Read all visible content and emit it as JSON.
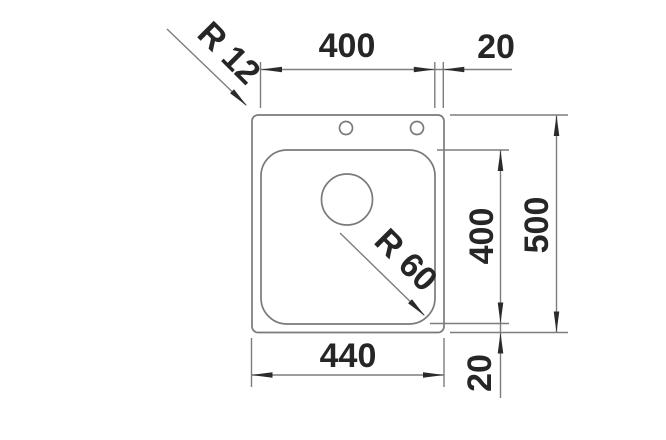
{
  "drawing": {
    "kind": "sink-dimension-drawing-top-view",
    "colors": {
      "background": "#ffffff",
      "line": "#7a7a7a",
      "text": "#262626",
      "arrow": "#2b2b2b"
    },
    "labels": {
      "top_width": "400",
      "top_offset": "20",
      "outer_radius": "R 12",
      "bowl_radius": "R 60",
      "right_depth": "400",
      "right_total": "500",
      "bottom_width": "440",
      "bottom_offset": "20"
    }
  }
}
